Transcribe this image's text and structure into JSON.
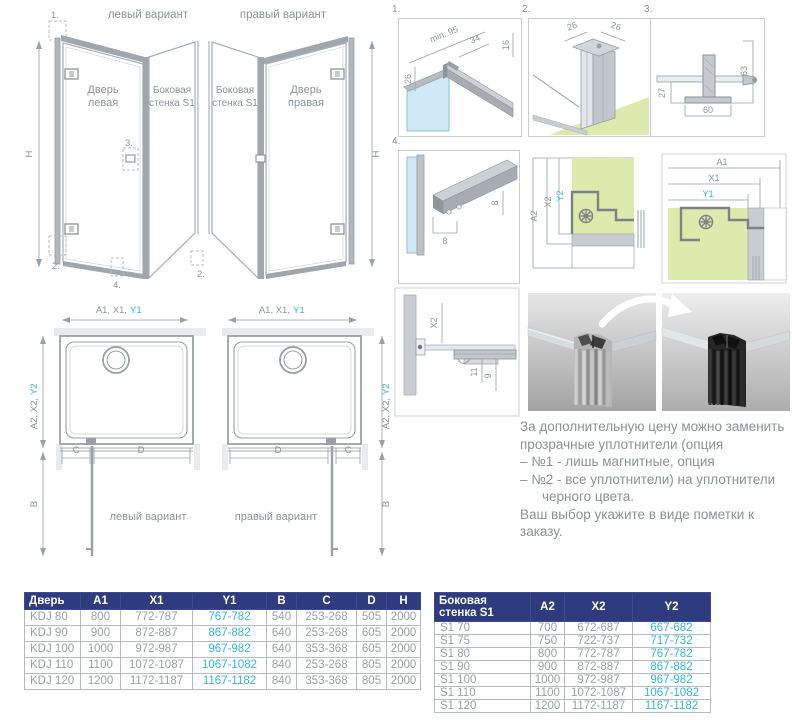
{
  "colors": {
    "accent_blue": "#33b5d9",
    "header_navy": "#2e3b7f",
    "tray_green": "#dde9ad",
    "glass_blue": "#cfe9f5",
    "line_gray": "#a4aab0"
  },
  "elevations": {
    "left": {
      "title": "левый вариант",
      "door_line1": "Дверь",
      "door_line2": "левая",
      "wall_line1": "Боковая",
      "wall_line2": "стенка S1",
      "h": "H",
      "marker1": "1.",
      "marker2a": "2.",
      "marker2b": "2.",
      "marker3": "3.",
      "marker4": "4."
    },
    "right": {
      "title": "правый вариант",
      "wall_line1": "Боковая",
      "wall_line2": "стенка S1",
      "door_line1": "Дверь",
      "door_line2": "правая",
      "h": "H"
    }
  },
  "details": {
    "d1": {
      "num": "1.",
      "dim_min": "min. 95",
      "dim_34": "34",
      "dim_16": "16",
      "dim_26": "26"
    },
    "d2": {
      "num": "2.",
      "dim_26a": "26",
      "dim_26b": "26"
    },
    "d3": {
      "num": "3.",
      "dim_63": "63",
      "dim_27": "27",
      "dim_60": "60"
    },
    "d4": {
      "num": "4.",
      "dim_8a": "8",
      "dim_8b": "8"
    },
    "corner_left": {
      "a2": "A2",
      "x2": "X2",
      "y2": "Y2"
    },
    "corner_right": {
      "a1": "A1",
      "x1": "X1",
      "y1": "Y1"
    },
    "section": {
      "x2": "X2",
      "d11": "11",
      "d9": "9"
    }
  },
  "plans": {
    "left": {
      "top_gray": "A1, X1,",
      "top_blue": "Y1",
      "side_gray": "A2, X2,",
      "side_blue": "Y2",
      "b": "B",
      "c": "C",
      "d": "D",
      "caption": "левый вариант"
    },
    "right": {
      "top_gray": "A1, X1,",
      "top_blue": "Y1",
      "side_gray": "A2, X2,",
      "side_blue": "Y2",
      "b": "B",
      "c": "C",
      "d": "D",
      "caption": "правый вариант"
    }
  },
  "note": {
    "line1": "За дополнительную цену можно заменить",
    "line2": "прозрачные уплотнители (опция",
    "line3": "– №1 - лишь магнитные, опция",
    "line4": "– №2 - все уплотнители)  на уплотнители",
    "line5": "черного цвета.",
    "line6": "Ваш выбор укажите в виде пометки к заказу."
  },
  "door_table": {
    "headers": [
      "Дверь",
      "A1",
      "X1",
      "Y1",
      "B",
      "C",
      "D",
      "H"
    ],
    "blue_col": 3,
    "rows": [
      [
        "KDJ 80",
        "800",
        "772-787",
        "767-782",
        "540",
        "253-268",
        "505",
        "2000"
      ],
      [
        "KDJ 90",
        "900",
        "872-887",
        "867-882",
        "640",
        "253-268",
        "605",
        "2000"
      ],
      [
        "KDJ 100",
        "1000",
        "972-987",
        "967-982",
        "640",
        "353-368",
        "605",
        "2000"
      ],
      [
        "KDJ 110",
        "1100",
        "1072-1087",
        "1067-1082",
        "840",
        "253-268",
        "805",
        "2000"
      ],
      [
        "KDJ 120",
        "1200",
        "1172-1187",
        "1167-1182",
        "840",
        "353-368",
        "805",
        "2000"
      ]
    ]
  },
  "wall_table": {
    "headers": [
      "Боковая стенка S1",
      "A2",
      "X2",
      "Y2"
    ],
    "blue_col": 3,
    "rows": [
      [
        "S1 70",
        "700",
        "672-687",
        "667-682"
      ],
      [
        "S1 75",
        "750",
        "722-737",
        "717-732"
      ],
      [
        "S1 80",
        "800",
        "772-787",
        "767-782"
      ],
      [
        "S1 90",
        "900",
        "872-887",
        "867-882"
      ],
      [
        "S1 100",
        "1000",
        "972-987",
        "967-982"
      ],
      [
        "S1 110",
        "1100",
        "1072-1087",
        "1067-1082"
      ],
      [
        "S1 120",
        "1200",
        "1172-1187",
        "1167-1182"
      ]
    ]
  }
}
